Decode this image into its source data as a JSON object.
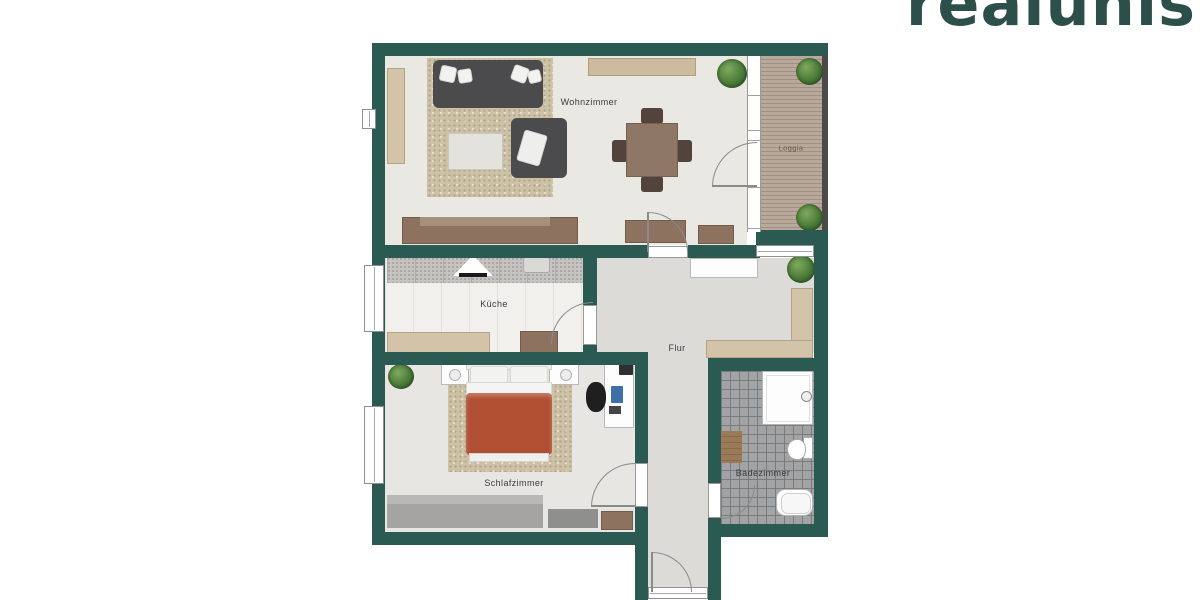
{
  "logo": {
    "text": "realunis"
  },
  "rooms": {
    "wohnzimmer": {
      "label": "Wohnzimmer"
    },
    "loggia": {
      "label": "Loggia"
    },
    "kueche": {
      "label": "Küche"
    },
    "flur": {
      "label": "Flur"
    },
    "schlafzimmer": {
      "label": "Schlafzimmer"
    },
    "badezimmer": {
      "label": "Badezimmer"
    }
  },
  "colors": {
    "wall": "#2b5a52",
    "logo_text": "#2d4f4a",
    "bed_duvet": "#b14f33",
    "wood_furniture": "#8d7260",
    "beige_furniture": "#d3c3a8",
    "loggia_deck": "#b3a296",
    "label_text": "#3c3c3c"
  }
}
